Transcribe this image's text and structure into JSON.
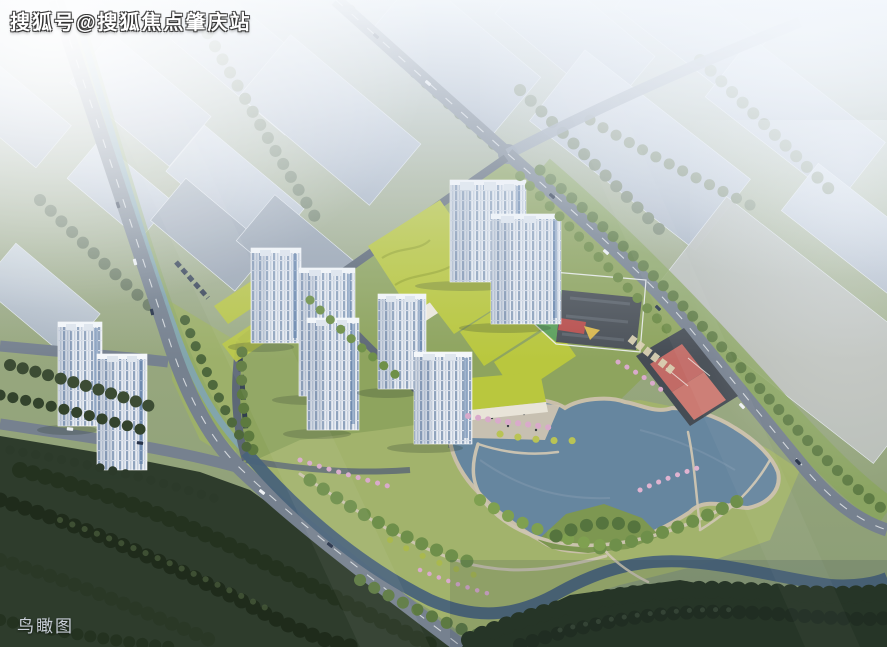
{
  "image": {
    "kind": "aerial-architectural-rendering",
    "subject": "bird's-eye masterplan rendering of a residential development with white high-rise towers, green-roof podium buildings, a kindergarten, basketball courts, a lake park, roads and surrounding massing buildings"
  },
  "watermark": {
    "text": "搜狐号@搜狐焦点肇庆站"
  },
  "caption": {
    "text": "鸟瞰图"
  },
  "features": [
    "context-buildings",
    "roads",
    "canal",
    "residential-towers",
    "green-roof-podium",
    "kindergarten",
    "basketball-courts",
    "surface-parking",
    "lake",
    "lakeside-promenade",
    "park-paths",
    "street-trees",
    "blossom-trees",
    "dark-forest",
    "stream",
    "haze"
  ],
  "palette": {
    "road": "#76818f",
    "roadDash": "#f2f4f6",
    "siteRoad": "#5d6876",
    "slab": "#c3ccd8",
    "slabDark": "#9aa5b3",
    "ctxGround": "#a9b49a",
    "ctxTree": "#72826a",
    "ground": "#8ea45e",
    "lawn": "#a2b36c",
    "roofGreen": "#b9c73e",
    "roofGreenLine": "#9fae2f",
    "towerFace": "#e9edf3",
    "towerWin": "#8fa3bd",
    "towerShade": "#5a7090",
    "glassBlue": "#4a6fa0",
    "lake": "#66869f",
    "shore": "#c9bfa9",
    "stream": "#49637a",
    "path": "#cfc6b2",
    "treeDark": "#24321f",
    "treeMid": "#46593a",
    "treeBright": "#739448",
    "parkTree": "#6e8f4a",
    "forest": "#2e3c2c",
    "blossom": "#d9aacb",
    "accentTree": "#b9c355",
    "court": "#c26b66",
    "courtApron": "#454c54",
    "kgRoof": "#4b5158",
    "kgGreen": "#5ca05c",
    "kgRed": "#c25858",
    "kgYellow": "#d9bd55",
    "kgBlue": "#5b86b8",
    "carDark": "#263248",
    "carLight": "#eef1f4",
    "watermark": "#ffffff",
    "caption": "#c9cfd8"
  }
}
